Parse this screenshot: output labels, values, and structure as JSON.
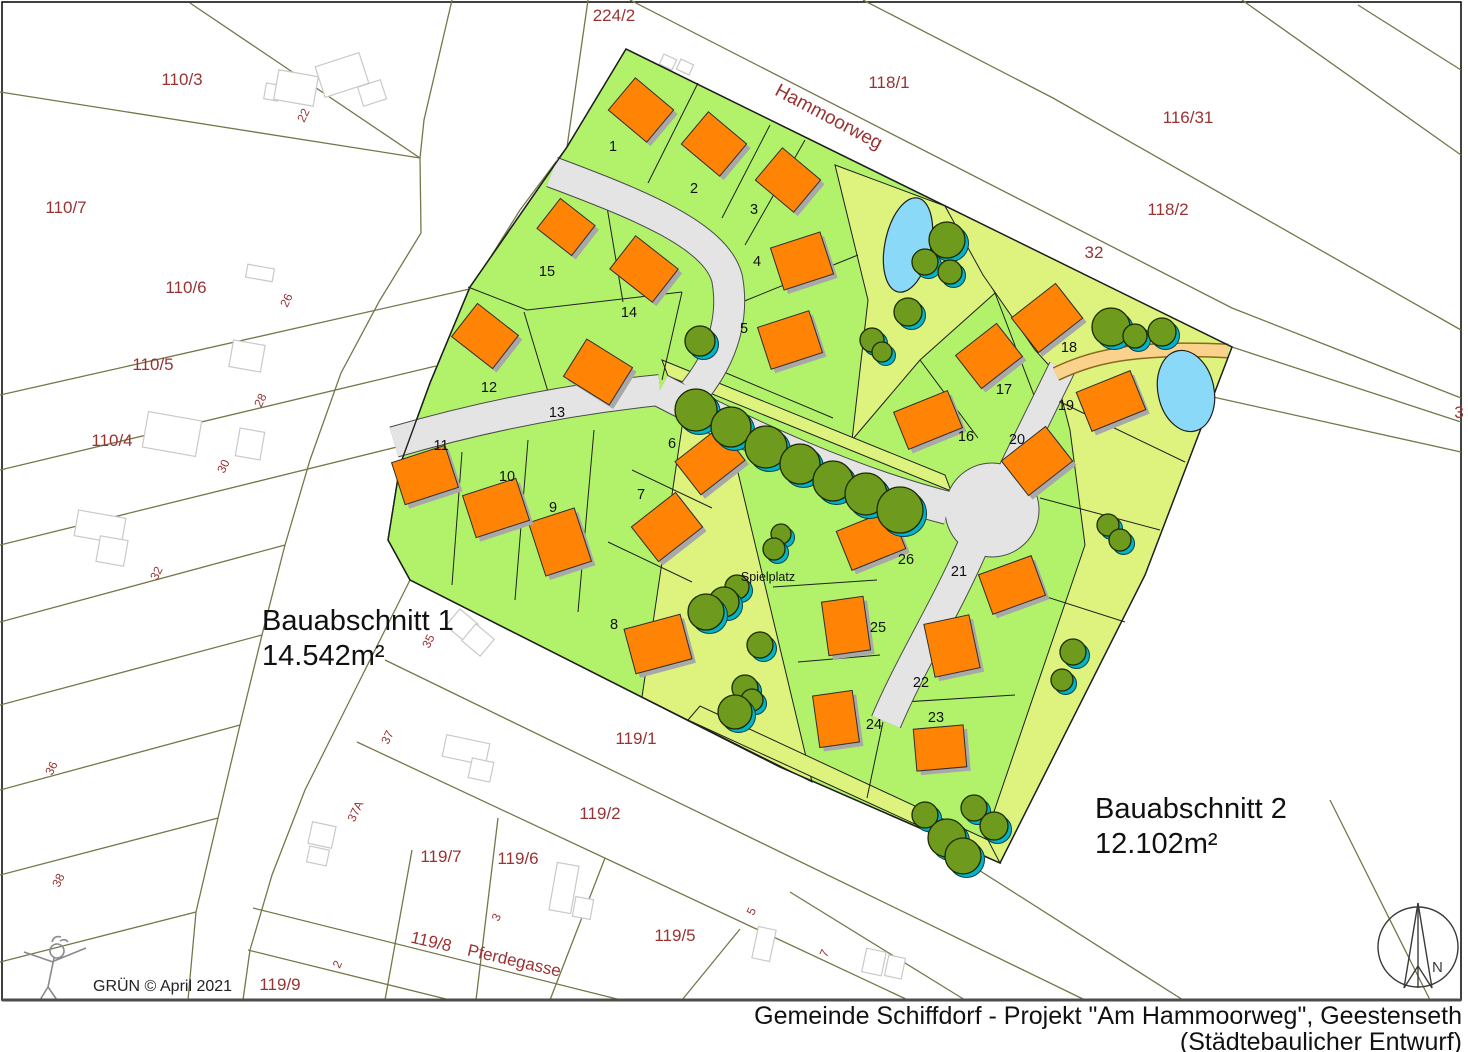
{
  "title_block": {
    "line1": "Gemeinde Schiffdorf - Projekt \"Am Hammoorweg\", Geestenseth",
    "line2": "(Städtebaulicher Entwurf)"
  },
  "credit": {
    "author": "GRÜN ©",
    "date": "April 2021"
  },
  "north": {
    "label": "N"
  },
  "areas": {
    "b1_name": "Bauabschnitt 1",
    "b1_area": "14.542m²",
    "b2_name": "Bauabschnitt 2",
    "b2_area": "12.102m²"
  },
  "labels": {
    "playground": "Spielplatz",
    "street_hammoorweg": "Hammoorweg",
    "street_pferdegasse": "Pferdegasse",
    "parcel_119_8": "119/8"
  },
  "colors": {
    "plot_green": "#b2f26a",
    "public_green": "#ddf37e",
    "building_orange": "#ff8405",
    "building_shadow": "#a8a8a8",
    "tree_green": "#6e9b1e",
    "tree_shadow": "#00b4cb",
    "water_blue": "#8bd9f8",
    "path_tan": "#fbd28b",
    "road_gray": "#e4e4e4",
    "cadastral_olive": "#76764a",
    "label_maroon": "#993333",
    "line_black": "#1f1f1f"
  },
  "parcel_labels": [
    {
      "t": "224/2",
      "x": 614,
      "y": 21
    },
    {
      "t": "118/1",
      "x": 889,
      "y": 88
    },
    {
      "t": "116/31",
      "x": 1188,
      "y": 123
    },
    {
      "t": "118/2",
      "x": 1168,
      "y": 215
    },
    {
      "t": "32",
      "x": 1094,
      "y": 258
    },
    {
      "t": "110/3",
      "x": 182,
      "y": 85
    },
    {
      "t": "110/7",
      "x": 66,
      "y": 213
    },
    {
      "t": "110/6",
      "x": 186,
      "y": 293
    },
    {
      "t": "110/5",
      "x": 153,
      "y": 370
    },
    {
      "t": "110/4",
      "x": 112,
      "y": 446
    },
    {
      "t": "119/1",
      "x": 636,
      "y": 744
    },
    {
      "t": "119/2",
      "x": 600,
      "y": 819
    },
    {
      "t": "119/7",
      "x": 441,
      "y": 862
    },
    {
      "t": "119/6",
      "x": 518,
      "y": 864
    },
    {
      "t": "119/5",
      "x": 675,
      "y": 941
    },
    {
      "t": "119/9",
      "x": 280,
      "y": 990
    },
    {
      "t": "3",
      "x": 1459,
      "y": 418
    }
  ],
  "house_numbers": [
    {
      "t": "22",
      "x": 307,
      "y": 117
    },
    {
      "t": "26",
      "x": 290,
      "y": 302
    },
    {
      "t": "28",
      "x": 264,
      "y": 402
    },
    {
      "t": "30",
      "x": 227,
      "y": 468
    },
    {
      "t": "32",
      "x": 160,
      "y": 575
    },
    {
      "t": "35",
      "x": 432,
      "y": 643
    },
    {
      "t": "36",
      "x": 55,
      "y": 770
    },
    {
      "t": "37",
      "x": 391,
      "y": 739
    },
    {
      "t": "37A",
      "x": 359,
      "y": 813
    },
    {
      "t": "38",
      "x": 62,
      "y": 882
    },
    {
      "t": "2",
      "x": 341,
      "y": 966
    },
    {
      "t": "3",
      "x": 500,
      "y": 919
    },
    {
      "t": "5",
      "x": 755,
      "y": 913
    },
    {
      "t": "7",
      "x": 828,
      "y": 955
    }
  ],
  "plot_numbers": [
    {
      "t": "1",
      "x": 613,
      "y": 151
    },
    {
      "t": "2",
      "x": 694,
      "y": 193
    },
    {
      "t": "3",
      "x": 754,
      "y": 214
    },
    {
      "t": "4",
      "x": 757,
      "y": 266
    },
    {
      "t": "5",
      "x": 744,
      "y": 333
    },
    {
      "t": "6",
      "x": 672,
      "y": 448
    },
    {
      "t": "7",
      "x": 641,
      "y": 499
    },
    {
      "t": "8",
      "x": 614,
      "y": 629
    },
    {
      "t": "9",
      "x": 553,
      "y": 512
    },
    {
      "t": "10",
      "x": 507,
      "y": 481
    },
    {
      "t": "11",
      "x": 441,
      "y": 450
    },
    {
      "t": "12",
      "x": 489,
      "y": 392
    },
    {
      "t": "13",
      "x": 557,
      "y": 417
    },
    {
      "t": "14",
      "x": 629,
      "y": 317
    },
    {
      "t": "15",
      "x": 547,
      "y": 276
    },
    {
      "t": "16",
      "x": 966,
      "y": 441
    },
    {
      "t": "17",
      "x": 1004,
      "y": 394
    },
    {
      "t": "18",
      "x": 1069,
      "y": 352
    },
    {
      "t": "19",
      "x": 1066,
      "y": 410
    },
    {
      "t": "20",
      "x": 1017,
      "y": 444
    },
    {
      "t": "21",
      "x": 959,
      "y": 576
    },
    {
      "t": "22",
      "x": 921,
      "y": 687
    },
    {
      "t": "23",
      "x": 936,
      "y": 722
    },
    {
      "t": "24",
      "x": 874,
      "y": 729
    },
    {
      "t": "25",
      "x": 878,
      "y": 632
    },
    {
      "t": "26",
      "x": 906,
      "y": 564
    }
  ],
  "features": {
    "buildings": [
      {
        "x": 641,
        "y": 110,
        "w": 50,
        "h": 42,
        "r": 40
      },
      {
        "x": 714,
        "y": 144,
        "w": 50,
        "h": 42,
        "r": 40
      },
      {
        "x": 788,
        "y": 180,
        "w": 50,
        "h": 42,
        "r": 40
      },
      {
        "x": 802,
        "y": 261,
        "w": 52,
        "h": 44,
        "r": -18
      },
      {
        "x": 790,
        "y": 340,
        "w": 54,
        "h": 44,
        "r": -18
      },
      {
        "x": 710,
        "y": 461,
        "w": 56,
        "h": 42,
        "r": -38
      },
      {
        "x": 667,
        "y": 527,
        "w": 56,
        "h": 44,
        "r": -38
      },
      {
        "x": 658,
        "y": 644,
        "w": 58,
        "h": 46,
        "r": -15
      },
      {
        "x": 560,
        "y": 542,
        "w": 48,
        "h": 56,
        "r": -18
      },
      {
        "x": 496,
        "y": 508,
        "w": 56,
        "h": 44,
        "r": -18
      },
      {
        "x": 425,
        "y": 475,
        "w": 56,
        "h": 44,
        "r": -18
      },
      {
        "x": 485,
        "y": 336,
        "w": 52,
        "h": 42,
        "r": 38
      },
      {
        "x": 598,
        "y": 372,
        "w": 54,
        "h": 44,
        "r": 32
      },
      {
        "x": 644,
        "y": 269,
        "w": 54,
        "h": 42,
        "r": 38
      },
      {
        "x": 566,
        "y": 227,
        "w": 44,
        "h": 38,
        "r": 38
      },
      {
        "x": 928,
        "y": 420,
        "w": 58,
        "h": 40,
        "r": -22
      },
      {
        "x": 989,
        "y": 356,
        "w": 52,
        "h": 42,
        "r": -38
      },
      {
        "x": 1047,
        "y": 318,
        "w": 56,
        "h": 44,
        "r": -38
      },
      {
        "x": 1111,
        "y": 401,
        "w": 58,
        "h": 42,
        "r": -22
      },
      {
        "x": 1037,
        "y": 461,
        "w": 56,
        "h": 44,
        "r": -38
      },
      {
        "x": 1012,
        "y": 585,
        "w": 56,
        "h": 42,
        "r": -20
      },
      {
        "x": 952,
        "y": 646,
        "w": 46,
        "h": 54,
        "r": -12
      },
      {
        "x": 940,
        "y": 748,
        "w": 50,
        "h": 42,
        "r": -5
      },
      {
        "x": 836,
        "y": 719,
        "w": 40,
        "h": 52,
        "r": -8
      },
      {
        "x": 846,
        "y": 626,
        "w": 42,
        "h": 54,
        "r": -8
      },
      {
        "x": 871,
        "y": 540,
        "w": 58,
        "h": 42,
        "r": -22
      }
    ],
    "trees": [
      {
        "x": 696,
        "y": 410,
        "r": 21
      },
      {
        "x": 731,
        "y": 427,
        "r": 20
      },
      {
        "x": 766,
        "y": 447,
        "r": 21
      },
      {
        "x": 800,
        "y": 464,
        "r": 20
      },
      {
        "x": 833,
        "y": 481,
        "r": 20
      },
      {
        "x": 866,
        "y": 494,
        "r": 21
      },
      {
        "x": 900,
        "y": 510,
        "r": 23
      },
      {
        "x": 700,
        "y": 341,
        "r": 15
      },
      {
        "x": 947,
        "y": 240,
        "r": 18
      },
      {
        "x": 925,
        "y": 262,
        "r": 13
      },
      {
        "x": 950,
        "y": 272,
        "r": 12
      },
      {
        "x": 908,
        "y": 312,
        "r": 14
      },
      {
        "x": 872,
        "y": 340,
        "r": 12
      },
      {
        "x": 882,
        "y": 352,
        "r": 10
      },
      {
        "x": 1111,
        "y": 327,
        "r": 19
      },
      {
        "x": 1135,
        "y": 336,
        "r": 12
      },
      {
        "x": 1162,
        "y": 332,
        "r": 14
      },
      {
        "x": 1108,
        "y": 525,
        "r": 11
      },
      {
        "x": 1120,
        "y": 540,
        "r": 11
      },
      {
        "x": 1073,
        "y": 652,
        "r": 13
      },
      {
        "x": 1062,
        "y": 680,
        "r": 11
      },
      {
        "x": 781,
        "y": 534,
        "r": 10
      },
      {
        "x": 774,
        "y": 549,
        "r": 11
      },
      {
        "x": 737,
        "y": 587,
        "r": 12
      },
      {
        "x": 724,
        "y": 602,
        "r": 15
      },
      {
        "x": 706,
        "y": 612,
        "r": 18
      },
      {
        "x": 760,
        "y": 645,
        "r": 13
      },
      {
        "x": 745,
        "y": 688,
        "r": 13
      },
      {
        "x": 752,
        "y": 700,
        "r": 11
      },
      {
        "x": 735,
        "y": 712,
        "r": 17
      },
      {
        "x": 925,
        "y": 815,
        "r": 13
      },
      {
        "x": 947,
        "y": 838,
        "r": 19
      },
      {
        "x": 974,
        "y": 808,
        "r": 13
      },
      {
        "x": 994,
        "y": 826,
        "r": 14
      },
      {
        "x": 963,
        "y": 856,
        "r": 18
      }
    ],
    "ponds": [
      {
        "x": 908,
        "y": 245,
        "rx": 23,
        "ry": 48,
        "r": 12
      },
      {
        "x": 1186,
        "y": 391,
        "rx": 28,
        "ry": 41,
        "r": -12
      }
    ],
    "outbuildings": [
      {
        "x": 272,
        "y": 92,
        "w": 14,
        "h": 16,
        "r": 10
      },
      {
        "x": 296,
        "y": 88,
        "w": 40,
        "h": 30,
        "r": 10
      },
      {
        "x": 342,
        "y": 75,
        "w": 46,
        "h": 32,
        "r": -18
      },
      {
        "x": 372,
        "y": 93,
        "w": 24,
        "h": 20,
        "r": -18
      },
      {
        "x": 260,
        "y": 273,
        "w": 27,
        "h": 13,
        "r": 10
      },
      {
        "x": 247,
        "y": 356,
        "w": 32,
        "h": 27,
        "r": 10
      },
      {
        "x": 172,
        "y": 434,
        "w": 54,
        "h": 36,
        "r": 10
      },
      {
        "x": 250,
        "y": 444,
        "w": 25,
        "h": 28,
        "r": 10
      },
      {
        "x": 100,
        "y": 527,
        "w": 48,
        "h": 26,
        "r": 10
      },
      {
        "x": 112,
        "y": 551,
        "w": 28,
        "h": 26,
        "r": 10
      },
      {
        "x": 466,
        "y": 750,
        "w": 44,
        "h": 22,
        "r": 12
      },
      {
        "x": 481,
        "y": 770,
        "w": 22,
        "h": 20,
        "r": 12
      },
      {
        "x": 322,
        "y": 835,
        "w": 24,
        "h": 22,
        "r": 12
      },
      {
        "x": 318,
        "y": 856,
        "w": 20,
        "h": 16,
        "r": 12
      },
      {
        "x": 564,
        "y": 888,
        "w": 22,
        "h": 48,
        "r": 10
      },
      {
        "x": 583,
        "y": 908,
        "w": 18,
        "h": 20,
        "r": 10
      },
      {
        "x": 668,
        "y": 62,
        "w": 14,
        "h": 11,
        "r": 25
      },
      {
        "x": 685,
        "y": 67,
        "w": 14,
        "h": 11,
        "r": 25
      },
      {
        "x": 462,
        "y": 625,
        "w": 24,
        "h": 22,
        "r": 40
      },
      {
        "x": 478,
        "y": 640,
        "w": 24,
        "h": 22,
        "r": 40
      },
      {
        "x": 764,
        "y": 944,
        "w": 18,
        "h": 32,
        "r": 12
      },
      {
        "x": 874,
        "y": 962,
        "w": 20,
        "h": 24,
        "r": 12
      },
      {
        "x": 895,
        "y": 967,
        "w": 17,
        "h": 21,
        "r": 12
      }
    ]
  }
}
